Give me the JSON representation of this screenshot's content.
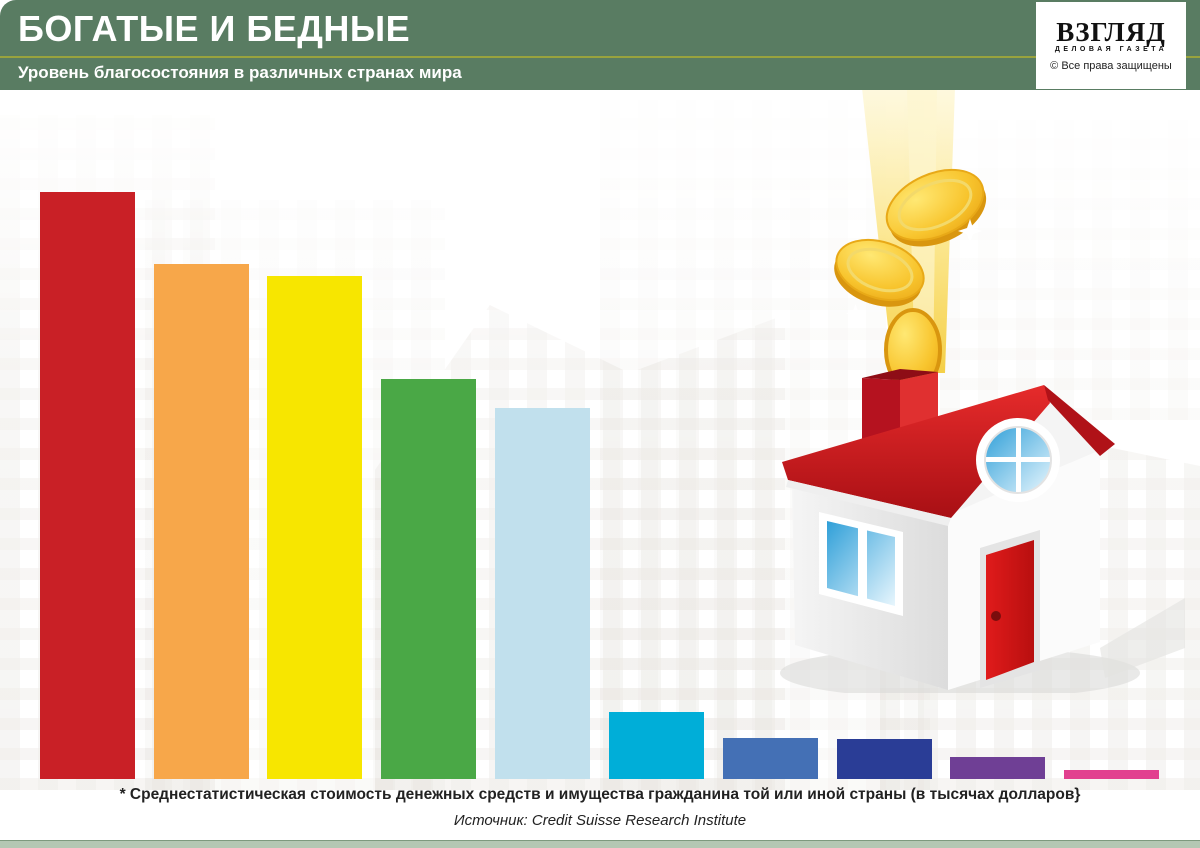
{
  "header": {
    "title": "БОГАТЫЕ И БЕДНЫЕ",
    "subtitle": "Уровень благосостояния в различных странах мира",
    "bg_color": "#597c62",
    "divider_color": "#99a33d"
  },
  "logo": {
    "name": "ВЗГЛЯД",
    "tagline": "ДЕЛОВАЯ ГАЗЕТА",
    "copyright": "© Все права защищены"
  },
  "chart_data": {
    "type": "bar",
    "title": "Уровень благосостояния в различных странах мира",
    "value_label_color": "#3e7b55",
    "baseline_y": 779,
    "bar_width_px": 95,
    "note": "small bars drawn on exaggerated scale in source infographic",
    "bars": [
      {
        "country": "Швейцария",
        "value": 372,
        "display": "372",
        "asterisk": true,
        "color": "#c92026",
        "x": 40,
        "top": 192
      },
      {
        "country": "Норвегия",
        "value": 326,
        "display": "326",
        "asterisk": false,
        "color": "#f7a74a",
        "x": 154,
        "top": 264
      },
      {
        "country": "Австралия",
        "value": 320,
        "display": "320",
        "asterisk": false,
        "color": "#f7e600",
        "x": 267,
        "top": 276
      },
      {
        "country": "Франция",
        "value": 255,
        "display": "255",
        "asterisk": false,
        "color": "#4aa846",
        "x": 381,
        "top": 379
      },
      {
        "country": "США",
        "value": 236,
        "display": "236",
        "asterisk": false,
        "color": "#c1e0ed",
        "x": 495,
        "top": 408
      },
      {
        "country": "Китай",
        "value": 17.1,
        "display": "17,1",
        "asterisk": false,
        "color": "#00aed8",
        "x": 609,
        "top": 712
      },
      {
        "country": "Латвия",
        "value": 10.8,
        "display": "10, 8",
        "asterisk": false,
        "color": "#4470b5",
        "x": 723,
        "top": 738
      },
      {
        "country": "Россия",
        "value": 10.4,
        "display": "10, 4",
        "asterisk": false,
        "color": "#2a3d96",
        "x": 837,
        "top": 739
      },
      {
        "country": "Белоруссия",
        "value": 6,
        "display": "6",
        "asterisk": false,
        "color": "#6f3f95",
        "x": 950,
        "top": 757
      },
      {
        "country": "Украина",
        "value": 2.7,
        "display": "2, 7",
        "asterisk": false,
        "color": "#e2408f",
        "x": 1064,
        "top": 770
      }
    ]
  },
  "footnote": "* Среднестатистическая стоимость денежных средств и имущества гражданина той или иной страны (в тысячах долларов}",
  "source": "Источник: Credit Suisse Research Institute"
}
